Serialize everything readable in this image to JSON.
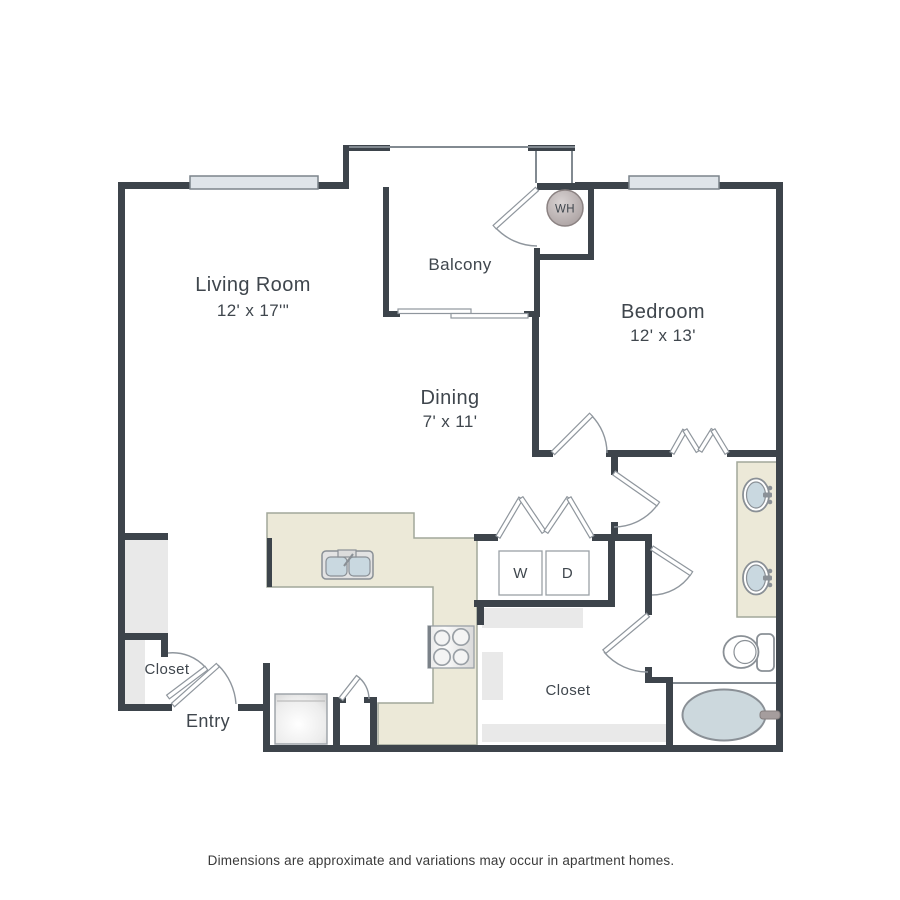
{
  "floorplan": {
    "rooms": {
      "living_room": {
        "name": "Living Room",
        "dims": "12' x 17'\""
      },
      "balcony": {
        "name": "Balcony"
      },
      "bedroom": {
        "name": "Bedroom",
        "dims": "12' x 13'"
      },
      "dining": {
        "name": "Dining",
        "dims": "7' x 11'"
      },
      "closet_left": {
        "name": "Closet"
      },
      "entry": {
        "name": "Entry"
      },
      "closet_middle": {
        "name": "Closet"
      }
    },
    "fixtures": {
      "washer_label": "W",
      "dryer_label": "D",
      "water_heater_label": "WH"
    },
    "footnote": "Dimensions are approximate and variations may occur in apartment homes.",
    "colors": {
      "wall": "#3d444b",
      "counter_beige": "#ece9d8",
      "fixture_blue": "#c9d8e0",
      "shading_gray": "#e9e9e9",
      "door_line_gray": "#8f969d",
      "text": "#3f464d"
    }
  }
}
